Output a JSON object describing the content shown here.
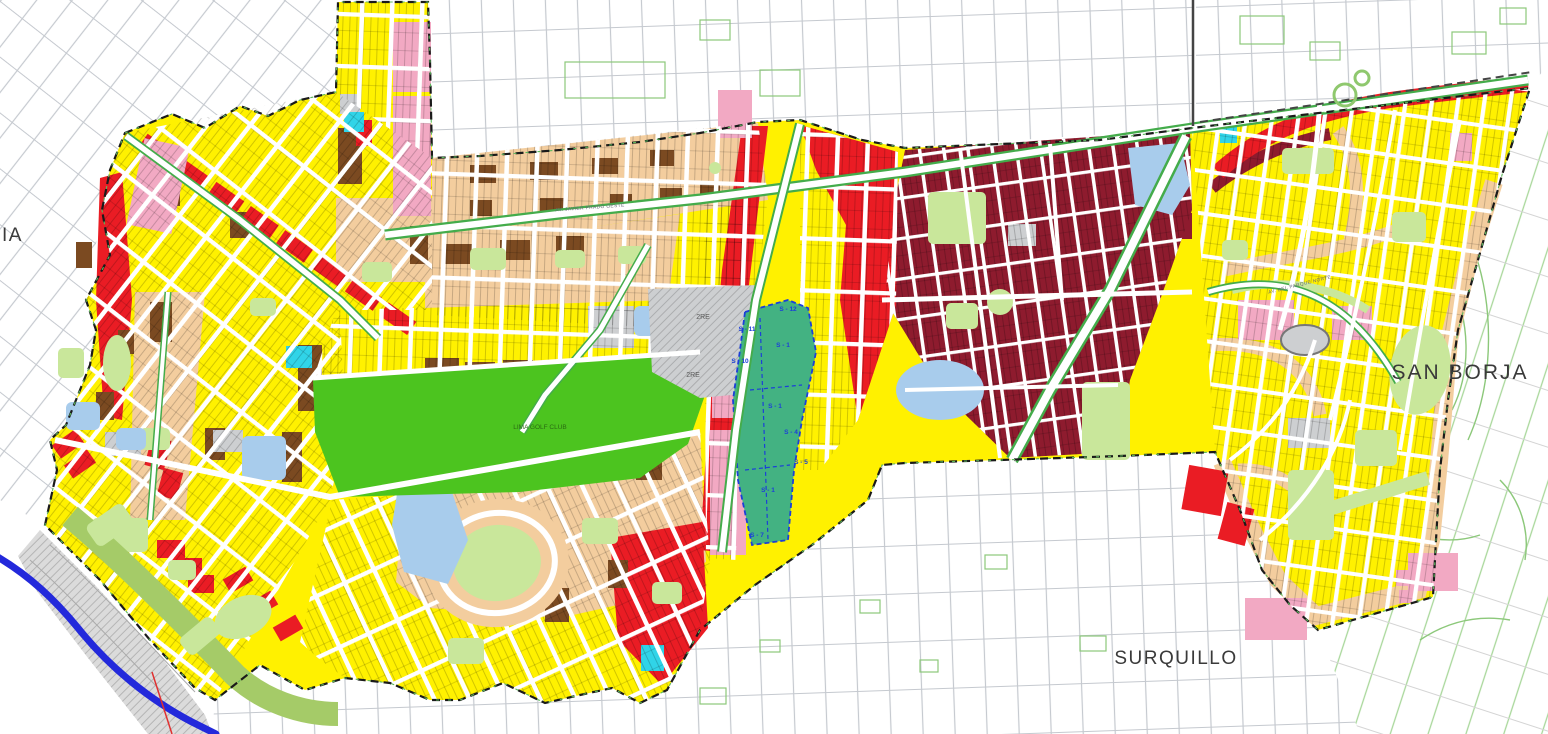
{
  "map": {
    "region_labels": {
      "san_borja": "SAN BORJA",
      "surquillo": "SURQUILLO",
      "west_partial": "IA"
    },
    "place_labels": {
      "golf": "LIMA GOLF CLUB",
      "re_zone_a": "2RE",
      "re_zone_b": "2RE",
      "street_javier_prado": "AV. JAVIER PRADO OESTE",
      "street_parque_norte": "AV. DEL PARQUE NORTE"
    },
    "sector_labels": [
      "S - 12",
      "S - 11",
      "S - 10",
      "S - 1",
      "S - 4",
      "S - 5",
      "S - 7"
    ],
    "colors": {
      "yellow": "#FFF100",
      "tan": "#F3CD9E",
      "brown": "#7B4A21",
      "red": "#EA1C24",
      "maroon": "#8E1B2E",
      "pink": "#F2A9C3",
      "green_bright": "#4CC41F",
      "green_light": "#C9E79B",
      "green_costa": "#A5CB68",
      "teal": "#43B282",
      "cyan": "#30D4E8",
      "water": "#A8CCEC",
      "gray_block": "#CDCFD1",
      "gray_cliff": "#DBDBDB",
      "coast_blue": "#2329DB",
      "thin_red": "#E03030",
      "boundary": "#1A1A1A",
      "sector_blue": "#1C3FD8",
      "median_green": "#44AC4B",
      "outside_gray": "#C7CBD1",
      "outside_green": "#8CC87A",
      "label": "#3A3A3A"
    }
  }
}
